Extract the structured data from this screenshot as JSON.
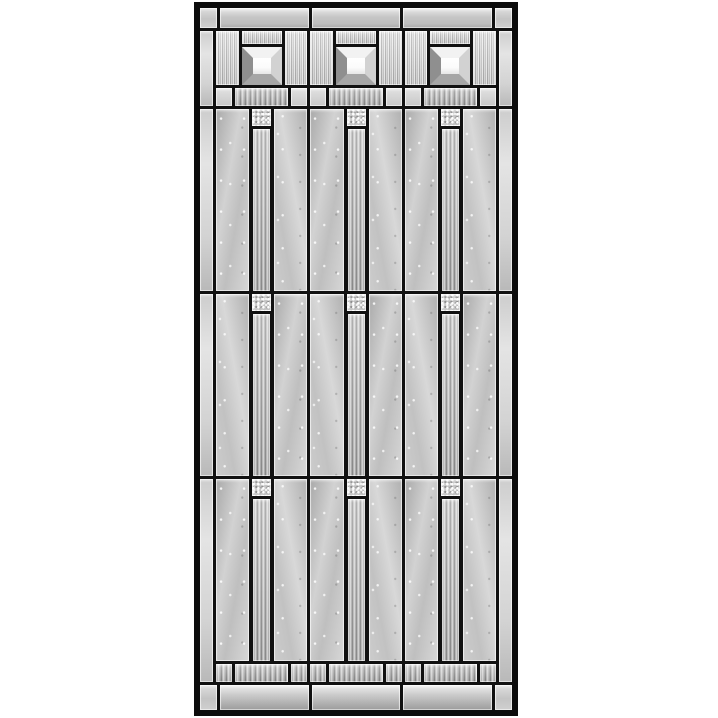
{
  "meta": {
    "description": "Product photo of a decorative beveled-glass door insert with a black frame and a craftsman-style geometric leaded glass pattern on a white background"
  },
  "colors": {
    "frame": "#0c0c0c",
    "lead": "#111111",
    "page-bg": "#ffffff",
    "glass-mid": "#c2c2c2",
    "glass-light": "#e8e8e8",
    "glass-dark": "#9a9a9a",
    "bevel-center": "#fbfbfb"
  },
  "structure": {
    "modules_across": 3,
    "tall_panel_rows": 3,
    "pyramid_bevel_jewels": 3,
    "gem_squares": 9,
    "ribbed_bands": 2,
    "rail_rows": 2
  }
}
